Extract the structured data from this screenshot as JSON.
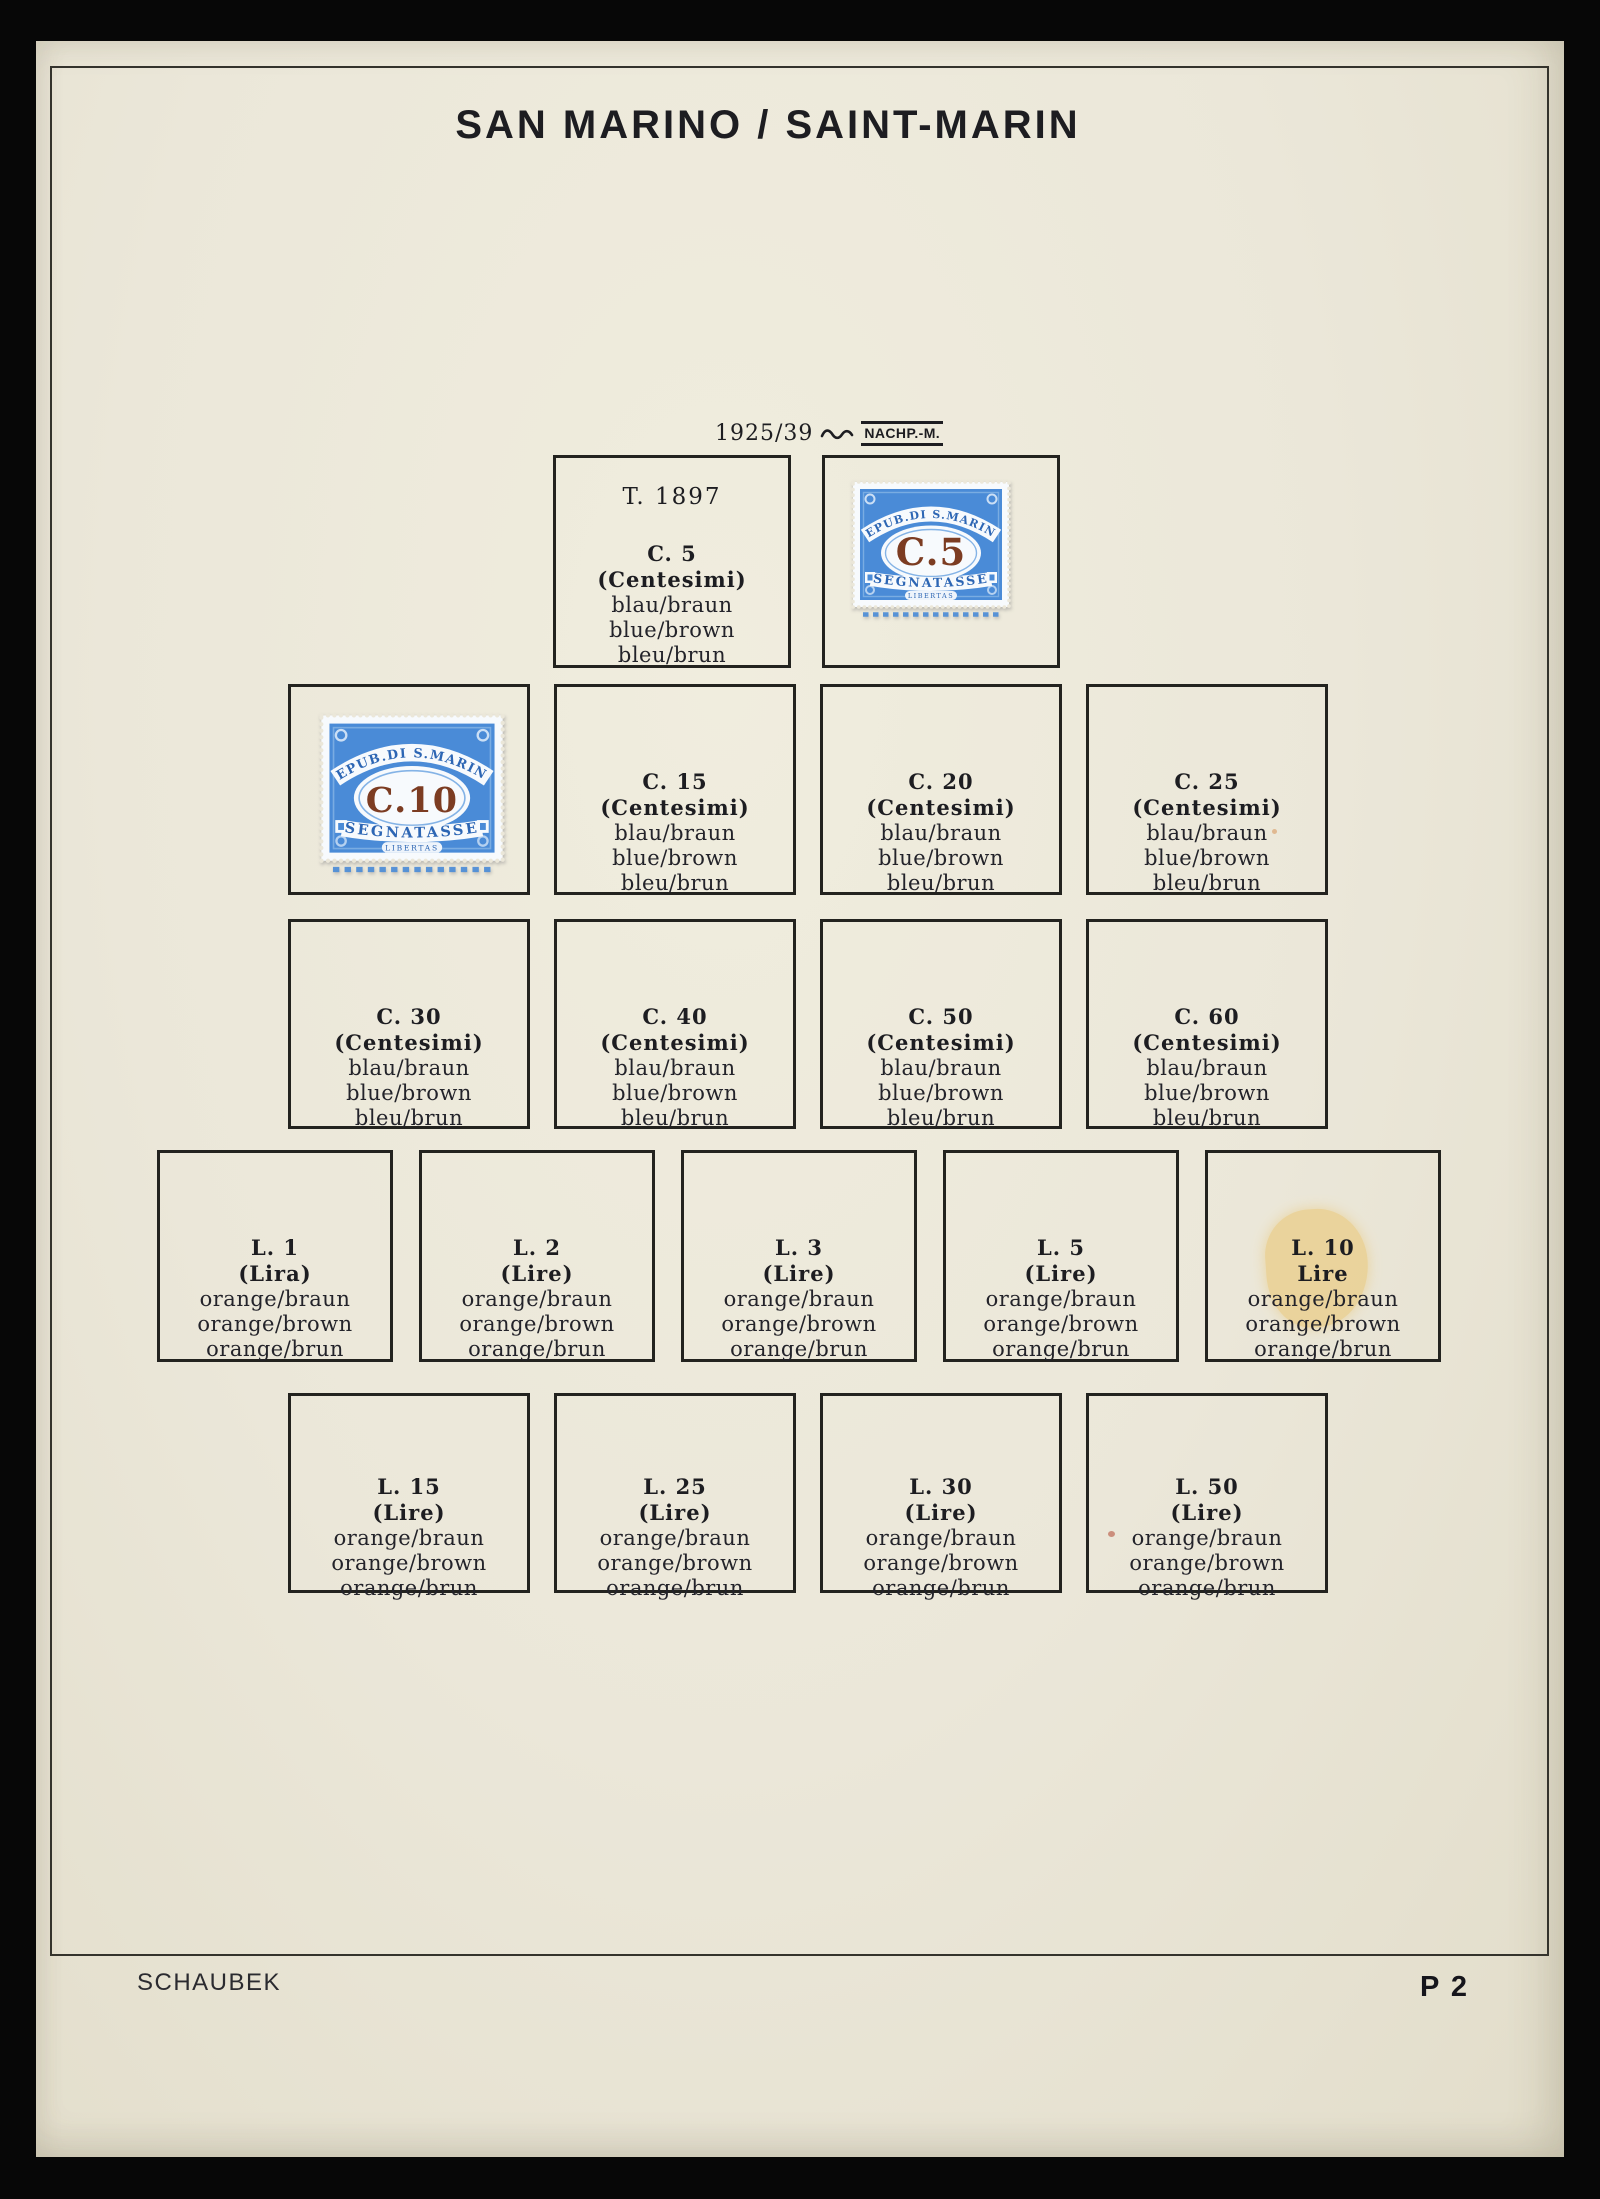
{
  "header": {
    "title": "SAN MARINO / SAINT-MARIN"
  },
  "series_header": {
    "years": "1925/39",
    "separator_icon": "wave-squiggle",
    "label": "NACHP.-M."
  },
  "footer": {
    "publisher": "SCHAUBEK",
    "page_number": "P 2"
  },
  "colors": {
    "paper": "#ebe7d9",
    "scan_edge": "#070707",
    "ink": "#1d1d21",
    "box_border": "#23231f",
    "stamp_blue": "#4a8bd7",
    "stamp_blue_deep": "#2d66b4",
    "stamp_paper": "#f7fafd",
    "numeral_brown": "#7c3c22",
    "stain": "#eace8c"
  },
  "stamps": [
    {
      "denomination": "C.5",
      "country": "REPUB.DI S.MARINO",
      "category": "SEGNATASSE",
      "motto": "LIBERTAS"
    },
    {
      "denomination": "C.10",
      "country": "REPUB.DI S.MARINO",
      "category": "SEGNATASSE",
      "motto": "LIBERTAS"
    }
  ],
  "rows": [
    {
      "boxes": [
        {
          "note": "T. 1897",
          "value": "C. 5",
          "unit": "(Centesimi)",
          "colors": [
            "blau/braun",
            "blue/brown",
            "bleu/brun"
          ]
        },
        {
          "stamp_ref": 0
        }
      ]
    },
    {
      "boxes": [
        {
          "stamp_ref": 1
        },
        {
          "value": "C. 15",
          "unit": "(Centesimi)",
          "colors": [
            "blau/braun",
            "blue/brown",
            "bleu/brun"
          ]
        },
        {
          "value": "C. 20",
          "unit": "(Centesimi)",
          "colors": [
            "blau/braun",
            "blue/brown",
            "bleu/brun"
          ]
        },
        {
          "value": "C. 25",
          "unit": "(Centesimi)",
          "colors": [
            "blau/braun",
            "blue/brown",
            "bleu/brun"
          ]
        }
      ]
    },
    {
      "boxes": [
        {
          "value": "C. 30",
          "unit": "(Centesimi)",
          "colors": [
            "blau/braun",
            "blue/brown",
            "bleu/brun"
          ]
        },
        {
          "value": "C. 40",
          "unit": "(Centesimi)",
          "colors": [
            "blau/braun",
            "blue/brown",
            "bleu/brun"
          ]
        },
        {
          "value": "C. 50",
          "unit": "(Centesimi)",
          "colors": [
            "blau/braun",
            "blue/brown",
            "bleu/brun"
          ]
        },
        {
          "value": "C. 60",
          "unit": "(Centesimi)",
          "colors": [
            "blau/braun",
            "blue/brown",
            "bleu/brun"
          ]
        }
      ]
    },
    {
      "boxes": [
        {
          "value": "L. 1",
          "unit": "(Lira)",
          "colors": [
            "orange/braun",
            "orange/brown",
            "orange/brun"
          ]
        },
        {
          "value": "L. 2",
          "unit": "(Lire)",
          "colors": [
            "orange/braun",
            "orange/brown",
            "orange/brun"
          ]
        },
        {
          "value": "L. 3",
          "unit": "(Lire)",
          "colors": [
            "orange/braun",
            "orange/brown",
            "orange/brun"
          ]
        },
        {
          "value": "L. 5",
          "unit": "(Lire)",
          "colors": [
            "orange/braun",
            "orange/brown",
            "orange/brun"
          ]
        },
        {
          "value": "L. 10",
          "unit": "Lire",
          "stain": true,
          "colors": [
            "orange/braun",
            "orange/brown",
            "orange/brun"
          ]
        }
      ]
    },
    {
      "boxes": [
        {
          "value": "L. 15",
          "unit": "(Lire)",
          "colors": [
            "orange/braun",
            "orange/brown",
            "orange/brun"
          ]
        },
        {
          "value": "L. 25",
          "unit": "(Lire)",
          "colors": [
            "orange/braun",
            "orange/brown",
            "orange/brun"
          ]
        },
        {
          "value": "L. 30",
          "unit": "(Lire)",
          "colors": [
            "orange/braun",
            "orange/brown",
            "orange/brun"
          ]
        },
        {
          "value": "L. 50",
          "unit": "(Lire)",
          "colors": [
            "orange/braun",
            "orange/brown",
            "orange/brun"
          ]
        }
      ]
    }
  ]
}
